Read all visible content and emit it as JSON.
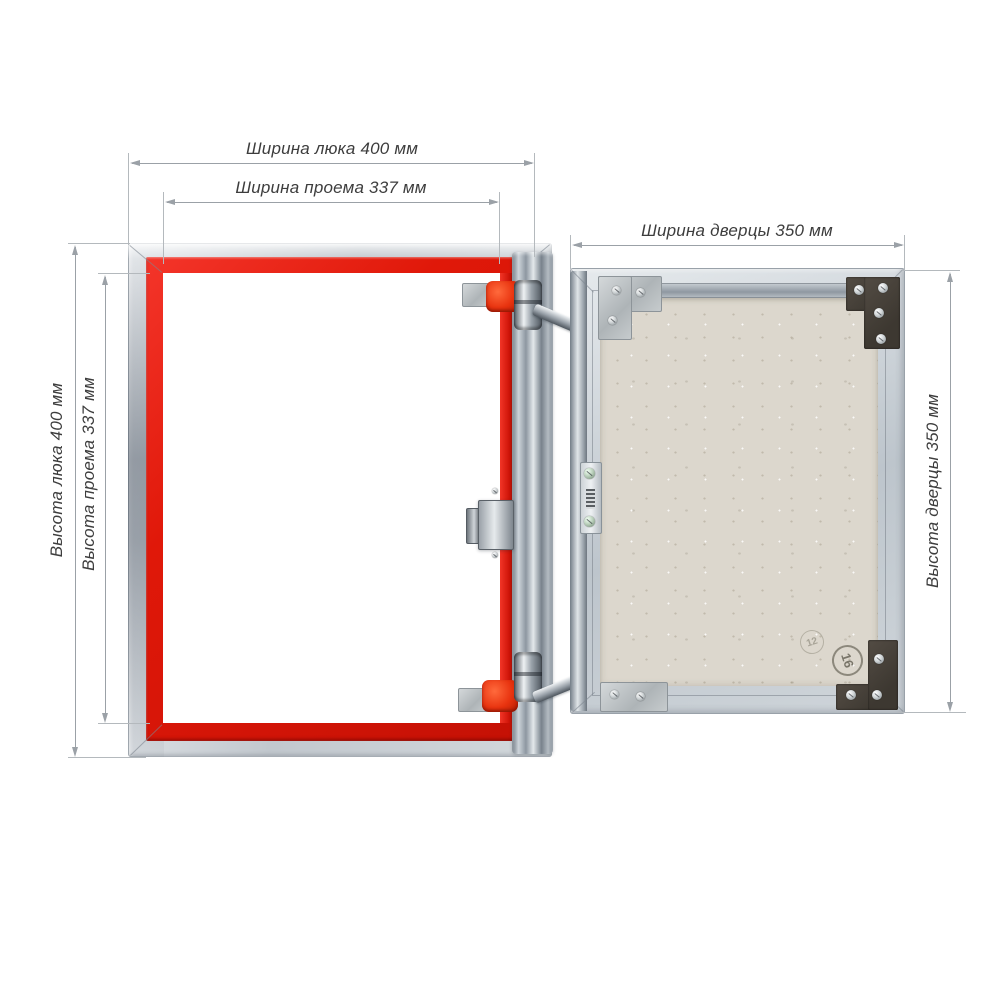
{
  "dimensions": {
    "hatch_width": {
      "label": "Ширина люка 400 мм",
      "value_mm": 400
    },
    "opening_width": {
      "label": "Ширина проема 337 мм",
      "value_mm": 337
    },
    "door_width": {
      "label": "Ширина дверцы 350 мм",
      "value_mm": 350
    },
    "hatch_height": {
      "label": "Высота люка 400 мм",
      "value_mm": 400
    },
    "opening_height": {
      "label": "Высота проема 337 мм",
      "value_mm": 337
    },
    "door_height": {
      "label": "Высота дверцы 350 мм",
      "value_mm": 350
    }
  },
  "stamps": {
    "left": "12",
    "right": "16"
  },
  "colors": {
    "background": "#ffffff",
    "dimension_line": "#9ba1a7",
    "label_text": "#3d3d3d",
    "seal_red": "#e01809",
    "frame_aluminum": "#c2c8ce",
    "door_panel_beige": "#dcd7cd"
  }
}
